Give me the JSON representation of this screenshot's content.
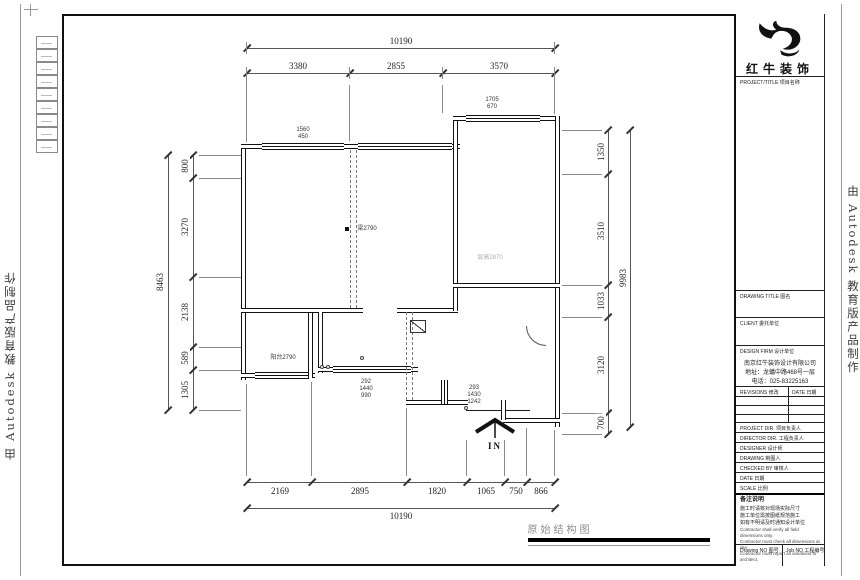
{
  "watermark": {
    "text": "由 Autodesk 教育版产品制作"
  },
  "title_block": {
    "brand": "红牛装饰",
    "project_title_label": "PROJECT/TITLE 项目名称",
    "drawing_title_label": "DRAWING TITLE 图名",
    "client_label": "CLIENT 委托单位",
    "design_firm_label": "DESIGN FIRM 设计单位",
    "firm_name": "南京红牛装饰设计有限公司",
    "firm_address": "地址：龙蟠中路468号一层",
    "firm_phone": "电话：025-83225163",
    "revisions_label": "REVISIONS 修改",
    "date_col_label": "DATE 日期",
    "personnel_rows": [
      "PROJECT DIR. 项目负责人",
      "DIRECTOR DIR. 工程负责人",
      "DESIGNER 设计师",
      "DRAWING 制图人",
      "CHECKED BY 审核人",
      "DATE 日期",
      "SCALE 比例"
    ],
    "notes_title": "备注说明",
    "notes_cn": "施工时请核对现场实际尺寸\n施工单位需按图纸规范施工\n如有不明请及时通知设计单位",
    "notes_en": "Contractor shall verify all field dimensions only.\nContractor must check all dimensions at site.\nContractor must report all variations to architect.",
    "drawing_no_label": "Drawing NO 图号",
    "job_no_label": "Job NO 工程编号"
  },
  "drawing": {
    "caption": "原始结构图",
    "entry_label": "IN",
    "plan_labels": {
      "window_top_left": "1560\n450",
      "window_top_right": "1705\n670",
      "beam": "梁2790",
      "floor_height": "层高2870",
      "balcony": "阳台2790",
      "dim_stack_left": "292\n1440\n990",
      "dim_stack_right": "293\n1430\n1242"
    },
    "dimensions": {
      "top_overall": "10190",
      "top_chain": [
        "3380",
        "2855",
        "3570"
      ],
      "bottom_chain": [
        "2169",
        "2895",
        "1820",
        "1065",
        "750",
        "866"
      ],
      "bottom_overall": "10190",
      "left_overall": "8463",
      "left_chain": [
        "800",
        "3270",
        "2138",
        "589",
        "1305"
      ],
      "right_chain": [
        "1350",
        "3510",
        "1033",
        "3120",
        "700"
      ],
      "right_overall": "9983"
    }
  }
}
